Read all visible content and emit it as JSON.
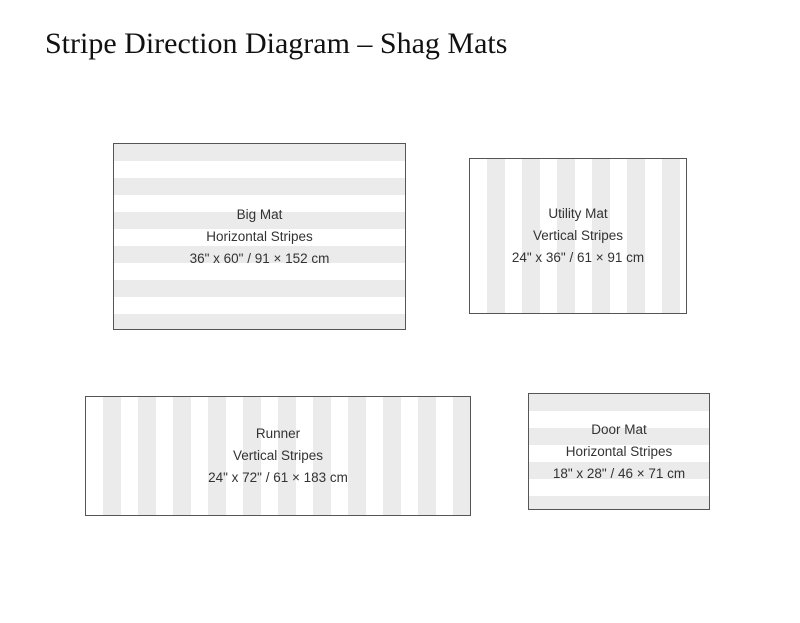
{
  "title": "Stripe Direction Diagram – Shag Mats",
  "mats": [
    {
      "name": "Big Mat",
      "stripe_direction": "Horizontal Stripes",
      "dimensions": "36\" x 60\" / 91 × 152 cm",
      "orientation": "horizontal"
    },
    {
      "name": "Utility Mat",
      "stripe_direction": "Vertical Stripes",
      "dimensions": "24\" x 36\" / 61 × 91 cm",
      "orientation": "vertical"
    },
    {
      "name": "Runner",
      "stripe_direction": "Vertical Stripes",
      "dimensions": "24\" x 72\" / 61 × 183 cm",
      "orientation": "vertical"
    },
    {
      "name": "Door Mat",
      "stripe_direction": "Horizontal Stripes",
      "dimensions": "18\" x 28\" / 46 × 71 cm",
      "orientation": "horizontal"
    }
  ],
  "colors": {
    "stripe_gray": "#ebebeb",
    "stripe_white": "#ffffff",
    "border": "#555555",
    "text": "#333333",
    "title": "#111111",
    "background": "#ffffff"
  }
}
